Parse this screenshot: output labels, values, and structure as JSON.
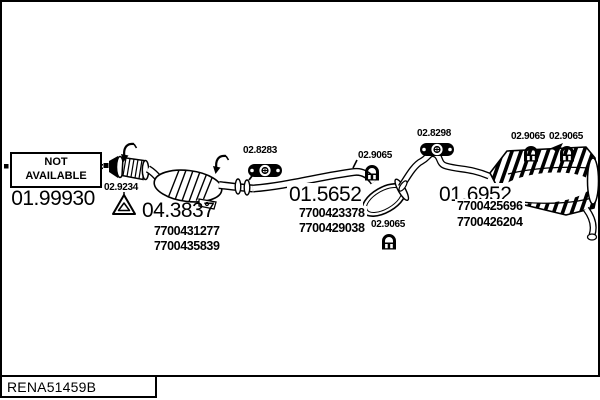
{
  "diagram": {
    "reference_code": "RENA51459B",
    "not_available": {
      "line1": "NOT",
      "line2": "AVAILABLE"
    },
    "front_pipe": {
      "code": "01.99930"
    },
    "gasket": {
      "code": "02.9234"
    },
    "catalyst": {
      "code": "04.3837",
      "oe1": "7700431277",
      "oe2": "7700435839"
    },
    "hanger_front": {
      "code": "02.8283"
    },
    "mid_silencer": {
      "code": "01.5652",
      "oe1": "7700423378",
      "oe2": "7700429038"
    },
    "clamp_mid_top": {
      "code": "02.9065"
    },
    "clamp_mid_bottom": {
      "code": "02.9065"
    },
    "hanger_rear": {
      "code": "02.8298"
    },
    "rear_silencer": {
      "code": "01.6952",
      "oe1": "7700425696",
      "oe2": "7700426204"
    },
    "clamp_rear_left": {
      "code": "02.9065"
    },
    "clamp_rear_right": {
      "code": "02.9065"
    },
    "colors": {
      "line": "#000000",
      "background": "#ffffff"
    }
  }
}
